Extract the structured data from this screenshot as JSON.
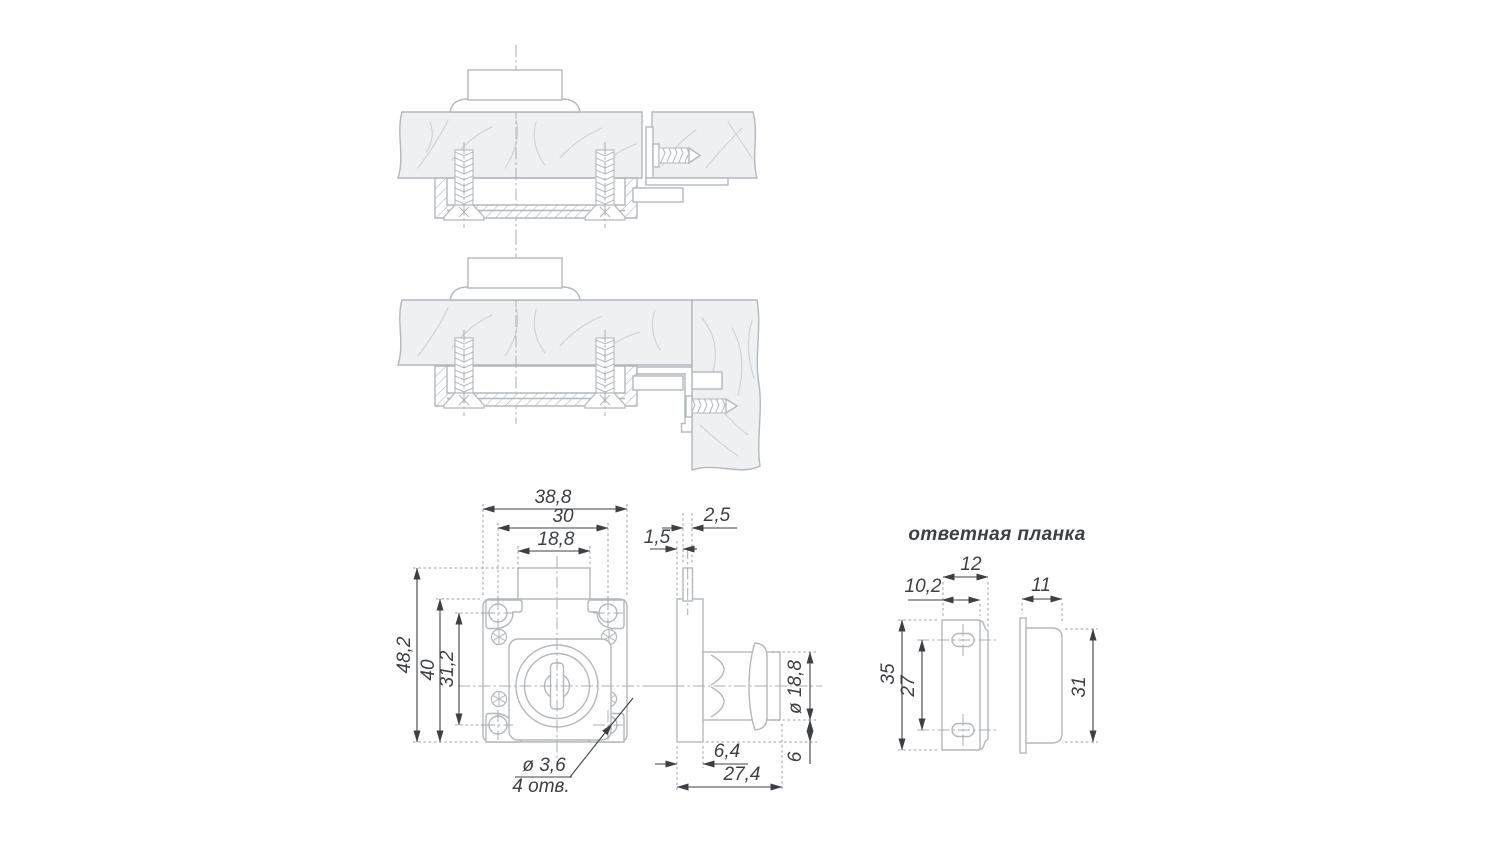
{
  "drawing": {
    "strike_plate_title": "ответная планка",
    "lock_front": {
      "dim_overall_width": "38,8",
      "dim_hole_spacing_h": "30",
      "dim_latch_width": "18,8",
      "dim_overall_height": "48,2",
      "dim_body_height": "40",
      "dim_hole_spacing_v": "31,2",
      "hole_callout_diameter": "ø 3,6",
      "hole_callout_count": "4 отв."
    },
    "lock_side": {
      "dim_latch_offset": "1,5",
      "dim_latch_thickness": "2,5",
      "dim_cylinder_diameter": "ø 18,8",
      "dim_case_depth": "6,4",
      "dim_total_depth": "27,4",
      "dim_cylinder_bottom_offset": "6"
    },
    "strike_front": {
      "dim_overall_width": "12",
      "dim_flat_width": "10,2",
      "dim_height": "35",
      "dim_hole_spacing": "27"
    },
    "strike_side": {
      "dim_depth": "11",
      "dim_height": "31"
    },
    "colors": {
      "line": "#b3b8bd",
      "wood_fill": "#eef0f2",
      "dimension": "#3c4045"
    }
  }
}
